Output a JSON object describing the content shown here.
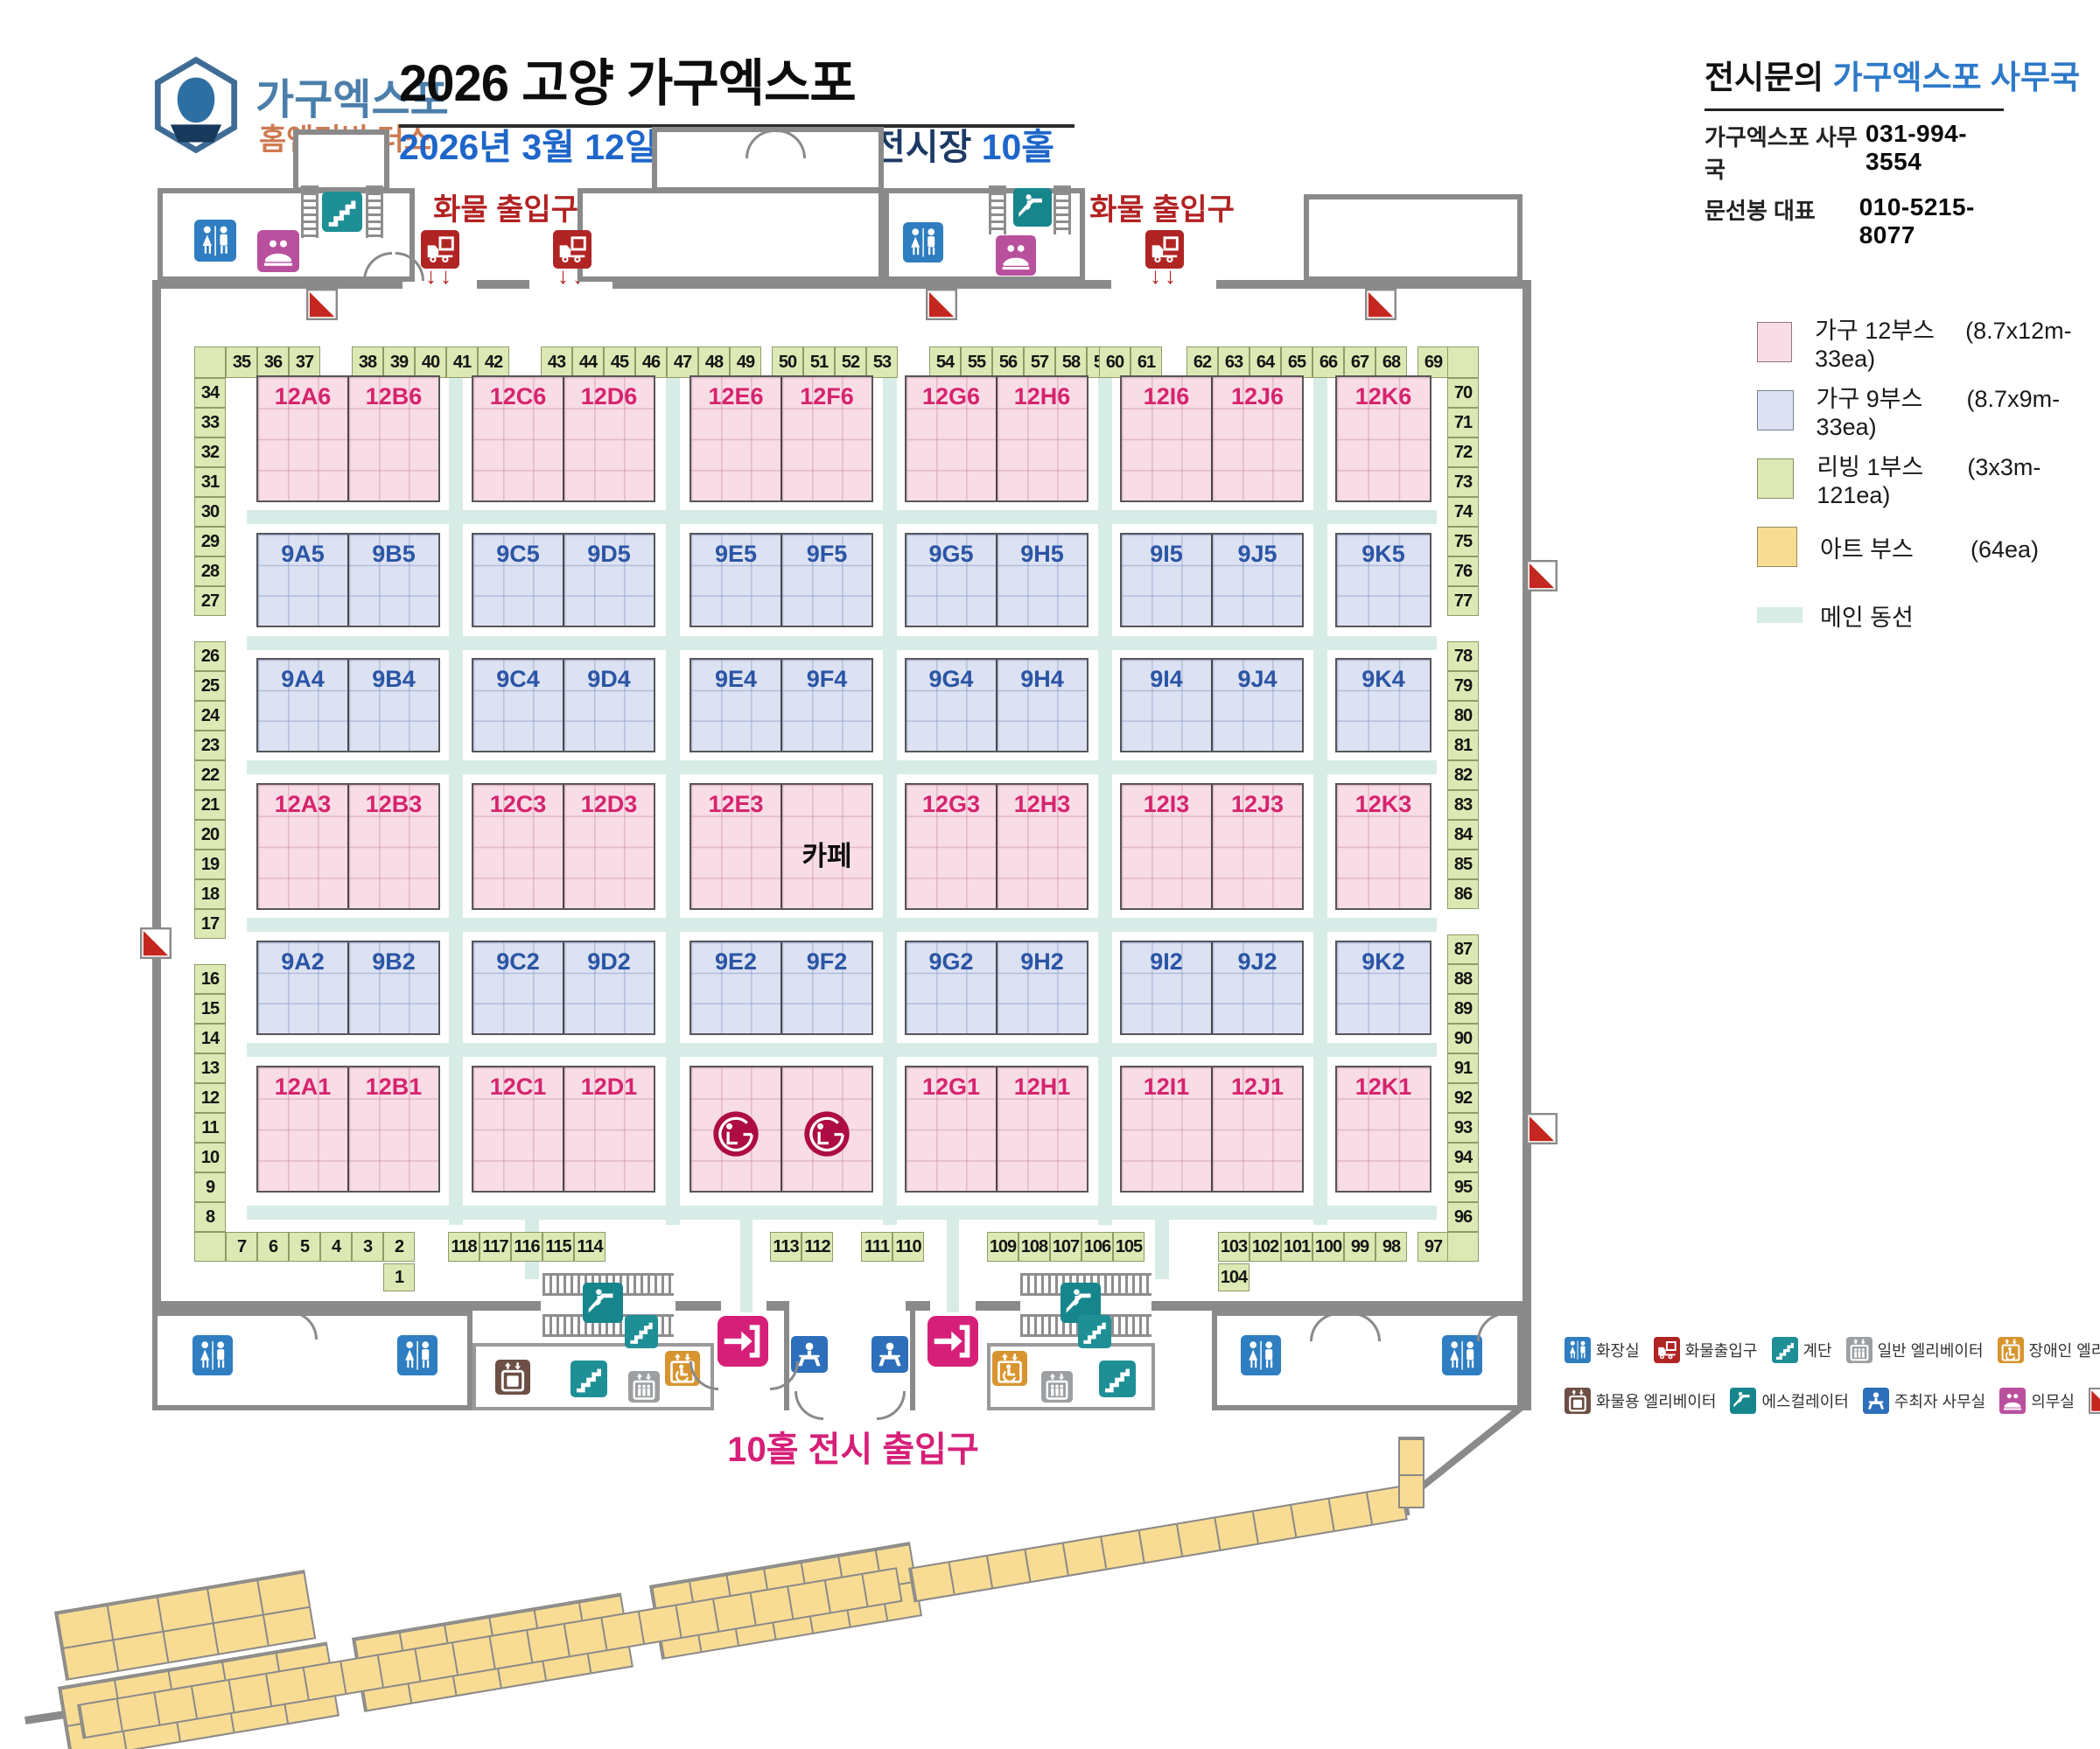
{
  "header": {
    "logo": {
      "line1": "가구엑스포",
      "line2": "홈앤리빙 더쇼"
    },
    "title": "2026 고양 가구엑스포",
    "subtitle": {
      "date": "2026년 3월 12일",
      "venue": " 일산 킨텍스 2전시장 ",
      "hall": "10홀"
    },
    "contact": {
      "prefix": "전시문의 ",
      "office": "가구엑스포 사무국",
      "rows": [
        {
          "label": "가구엑스포 사무국",
          "value": "031-994-3554"
        },
        {
          "label": "문선봉 대표",
          "value": "010-5215-8077"
        }
      ]
    }
  },
  "legend": {
    "items": [
      {
        "name": "가구 12부스",
        "spec": "(8.7x12m-33ea)",
        "color": "#F8DCE6",
        "border": "#8d7680",
        "type": "box"
      },
      {
        "name": "가구 9부스",
        "spec": "(8.7x9m-33ea)",
        "color": "#DCE2F2",
        "border": "#77808f",
        "type": "box"
      },
      {
        "name": "리빙 1부스",
        "spec": "(3x3m-121ea)",
        "color": "#DDE9B4",
        "border": "#868f66",
        "type": "box"
      },
      {
        "name": "아트 부스",
        "spec": "(64ea)",
        "color": "#F8DC94",
        "border": "#9a8a5a",
        "type": "box"
      },
      {
        "name": "메인 동선",
        "spec": "",
        "color": "#D7ECE6",
        "border": "",
        "type": "path"
      }
    ]
  },
  "labels": {
    "cargo": "화물 출입구",
    "entrance": "10홀 전시 출입구",
    "arrows": "↓↓"
  },
  "icon_legend": [
    [
      {
        "icon": "wc",
        "label": "화장실"
      },
      {
        "icon": "truck",
        "label": "화물출입구"
      },
      {
        "icon": "stairs",
        "label": "계단"
      },
      {
        "icon": "elev",
        "label": "일반 엘리베이터"
      },
      {
        "icon": "elev-dis",
        "label": "장애인 엘리베이터"
      }
    ],
    [
      {
        "icon": "elev-cargo",
        "label": "화물용 엘리베이터"
      },
      {
        "icon": "esc",
        "label": "에스컬레이터"
      },
      {
        "icon": "office",
        "label": "주최자 사무실"
      },
      {
        "icon": "medical",
        "label": "의무실"
      },
      {
        "icon": "fire",
        "label": "소화전"
      }
    ]
  ],
  "floor": {
    "booth_rows": [
      {
        "kind": "p",
        "blocks": [
          [
            {
              "label": "12A6"
            },
            {
              "label": "12B6"
            }
          ],
          [
            {
              "label": "12C6"
            },
            {
              "label": "12D6"
            }
          ],
          [
            {
              "label": "12E6"
            },
            {
              "label": "12F6"
            }
          ],
          [
            {
              "label": "12G6"
            },
            {
              "label": "12H6"
            }
          ],
          [
            {
              "label": "12I6"
            },
            {
              "label": "12J6"
            }
          ],
          [
            {
              "label": "12K6"
            }
          ]
        ]
      },
      {
        "kind": "b",
        "blocks": [
          [
            {
              "label": "9A5"
            },
            {
              "label": "9B5"
            }
          ],
          [
            {
              "label": "9C5"
            },
            {
              "label": "9D5"
            }
          ],
          [
            {
              "label": "9E5"
            },
            {
              "label": "9F5"
            }
          ],
          [
            {
              "label": "9G5"
            },
            {
              "label": "9H5"
            }
          ],
          [
            {
              "label": "9I5"
            },
            {
              "label": "9J5"
            }
          ],
          [
            {
              "label": "9K5"
            }
          ]
        ]
      },
      {
        "kind": "b",
        "blocks": [
          [
            {
              "label": "9A4"
            },
            {
              "label": "9B4"
            }
          ],
          [
            {
              "label": "9C4"
            },
            {
              "label": "9D4"
            }
          ],
          [
            {
              "label": "9E4"
            },
            {
              "label": "9F4"
            }
          ],
          [
            {
              "label": "9G4"
            },
            {
              "label": "9H4"
            }
          ],
          [
            {
              "label": "9I4"
            },
            {
              "label": "9J4"
            }
          ],
          [
            {
              "label": "9K4"
            }
          ]
        ]
      },
      {
        "kind": "p",
        "blocks": [
          [
            {
              "label": "12A3"
            },
            {
              "label": "12B3"
            }
          ],
          [
            {
              "label": "12C3"
            },
            {
              "label": "12D3"
            }
          ],
          [
            {
              "label": "12E3"
            },
            {
              "label": "카페",
              "type": "cafe"
            }
          ],
          [
            {
              "label": "12G3"
            },
            {
              "label": "12H3"
            }
          ],
          [
            {
              "label": "12I3"
            },
            {
              "label": "12J3"
            }
          ],
          [
            {
              "label": "12K3"
            }
          ]
        ]
      },
      {
        "kind": "b",
        "blocks": [
          [
            {
              "label": "9A2"
            },
            {
              "label": "9B2"
            }
          ],
          [
            {
              "label": "9C2"
            },
            {
              "label": "9D2"
            }
          ],
          [
            {
              "label": "9E2"
            },
            {
              "label": "9F2"
            }
          ],
          [
            {
              "label": "9G2"
            },
            {
              "label": "9H2"
            }
          ],
          [
            {
              "label": "9I2"
            },
            {
              "label": "9J2"
            }
          ],
          [
            {
              "label": "9K2"
            }
          ]
        ]
      },
      {
        "kind": "p",
        "blocks": [
          [
            {
              "label": "12A1"
            },
            {
              "label": "12B1"
            }
          ],
          [
            {
              "label": "12C1"
            },
            {
              "label": "12D1"
            }
          ],
          [
            {
              "type": "lg"
            },
            {
              "type": "lg"
            }
          ],
          [
            {
              "label": "12G1"
            },
            {
              "label": "12H1"
            }
          ],
          [
            {
              "label": "12I1"
            },
            {
              "label": "12J1"
            }
          ],
          [
            {
              "label": "12K1"
            }
          ]
        ]
      }
    ],
    "living": {
      "top_groups": [
        [
          "35",
          "36",
          "37"
        ],
        [
          "38",
          "39",
          "40",
          "41",
          "42"
        ],
        [
          "43",
          "44",
          "45",
          "46",
          "47",
          "48",
          "49"
        ],
        [
          "50",
          "51",
          "52",
          "53"
        ],
        [
          "54",
          "55",
          "56",
          "57",
          "58",
          "59"
        ],
        [
          "60",
          "61"
        ],
        [
          "62",
          "63",
          "64",
          "65",
          "66",
          "67",
          "68"
        ],
        [
          "69"
        ]
      ],
      "left_groups": [
        [
          "34",
          "33",
          "32",
          "31",
          "30",
          "29",
          "28",
          "27"
        ],
        [
          "26",
          "25",
          "24",
          "23",
          "22",
          "21",
          "20",
          "19",
          "18",
          "17"
        ],
        [
          "16",
          "15",
          "14",
          "13",
          "12",
          "11",
          "10",
          "9",
          "8"
        ]
      ],
      "right_groups": [
        [
          "70",
          "71",
          "72",
          "73",
          "74",
          "75",
          "76",
          "77"
        ],
        [
          "78",
          "79",
          "80",
          "81",
          "82",
          "83",
          "84",
          "85",
          "86"
        ],
        [
          "87",
          "88",
          "89",
          "90",
          "91",
          "92",
          "93",
          "94",
          "95",
          "96"
        ]
      ],
      "bottom_groups": [
        [
          "7"
        ],
        [
          "6",
          "5",
          "4",
          "3",
          "2"
        ],
        [
          "118",
          "117",
          "116",
          "115",
          "114"
        ],
        [
          "113",
          "112"
        ],
        [
          "111",
          "110"
        ],
        [
          "109",
          "108",
          "107",
          "106",
          "105"
        ],
        [
          "103",
          "102",
          "101",
          "100",
          "99",
          "98"
        ],
        [
          "97"
        ]
      ],
      "below": {
        "b1": "1",
        "b104": "104"
      }
    }
  }
}
